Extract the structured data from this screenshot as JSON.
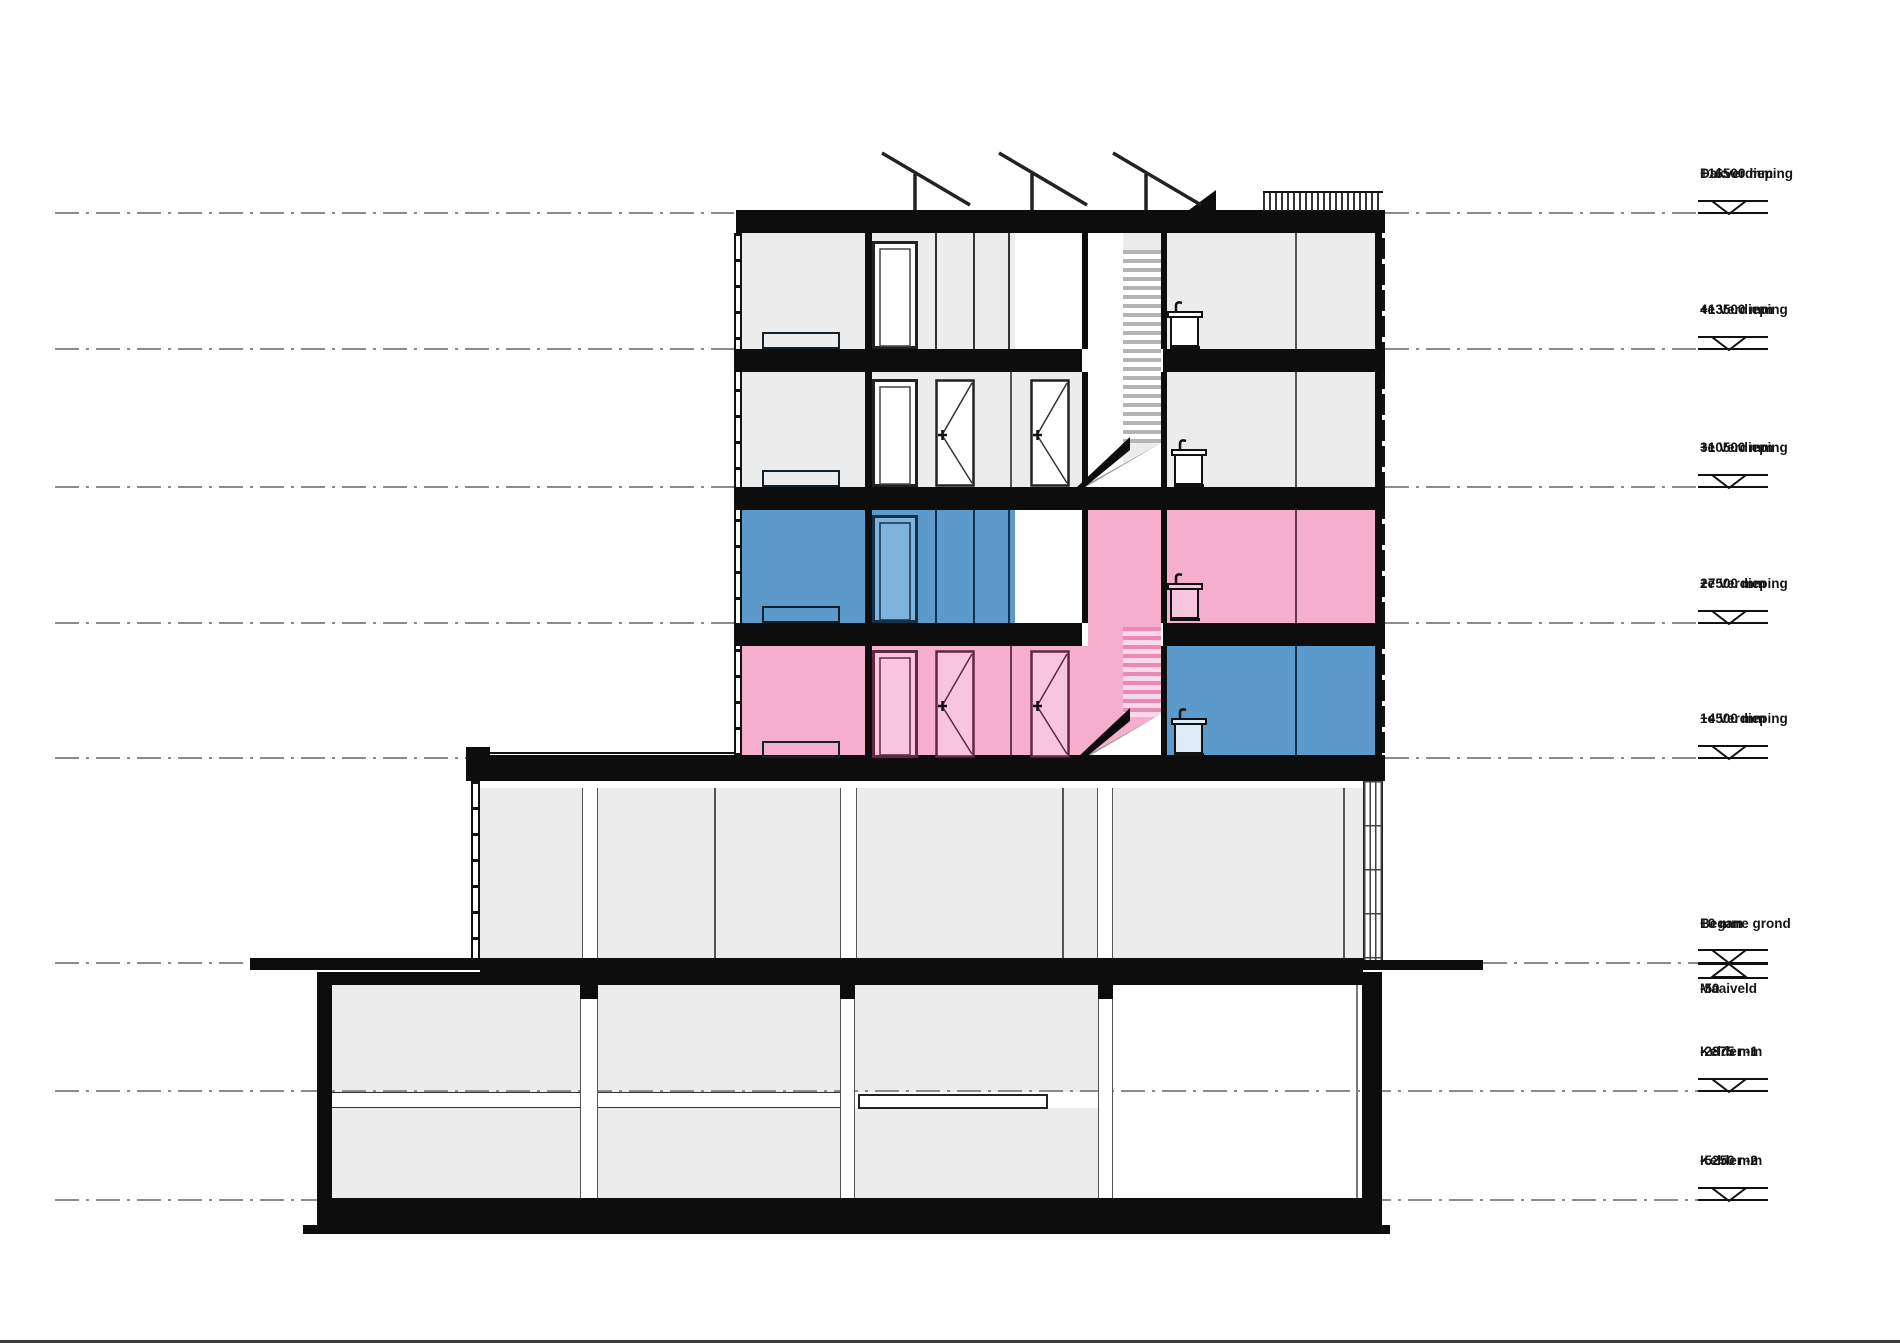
{
  "drawing": {
    "type": "building-section",
    "units": "mm"
  },
  "colors": {
    "unit_blue": "#5B9ACA",
    "unit_blue_light": "#7FB3DC",
    "unit_pink": "#F5AECB",
    "unit_pink_light": "#F8C6DC",
    "room_gray": "#ECECEC",
    "wall_black": "#0D0D0D",
    "dash_gray": "#8C8C8C"
  },
  "levels": [
    {
      "id": "dak",
      "label": "Dakverdieping",
      "elevation": "+16500 mm",
      "y": 213,
      "marker": "triangle",
      "dash": [
        [
          55,
          734
        ],
        [
          1385,
          1698
        ]
      ]
    },
    {
      "id": "v4",
      "label": "4e Verdieping",
      "elevation": "+13500 mm",
      "y": 349,
      "marker": "triangle",
      "dash": [
        [
          55,
          734
        ],
        [
          1385,
          1698
        ]
      ]
    },
    {
      "id": "v3",
      "label": "3e Verdieping",
      "elevation": "+10500 mm",
      "y": 487,
      "marker": "triangle",
      "dash": [
        [
          55,
          734
        ],
        [
          1385,
          1698
        ]
      ]
    },
    {
      "id": "v2",
      "label": "2e Verdieping",
      "elevation": "+7500 mm",
      "y": 623,
      "marker": "triangle",
      "dash": [
        [
          55,
          734
        ],
        [
          1385,
          1698
        ]
      ]
    },
    {
      "id": "v1",
      "label": "1e Verdieping",
      "elevation": "+4500 mm",
      "y": 758,
      "marker": "triangle",
      "dash": [
        [
          55,
          466
        ],
        [
          1385,
          1698
        ]
      ]
    },
    {
      "id": "bg",
      "label": "Begane grond",
      "elevation": "+0 mm",
      "y": 963,
      "marker": "cross",
      "sub": [
        "-50",
        "Maaiveld"
      ],
      "dash": [
        [
          55,
          250
        ],
        [
          1483,
          1698
        ]
      ]
    },
    {
      "id": "k1",
      "label": "Kelder -1",
      "elevation": "-2875 mm",
      "y": 1091,
      "marker": "triangle",
      "dash": [
        [
          55,
          1698
        ]
      ]
    },
    {
      "id": "k2",
      "label": "Kelder -2",
      "elevation": "-5250 mm",
      "y": 1200,
      "marker": "triangle",
      "dash": [
        [
          55,
          1698
        ]
      ]
    }
  ]
}
